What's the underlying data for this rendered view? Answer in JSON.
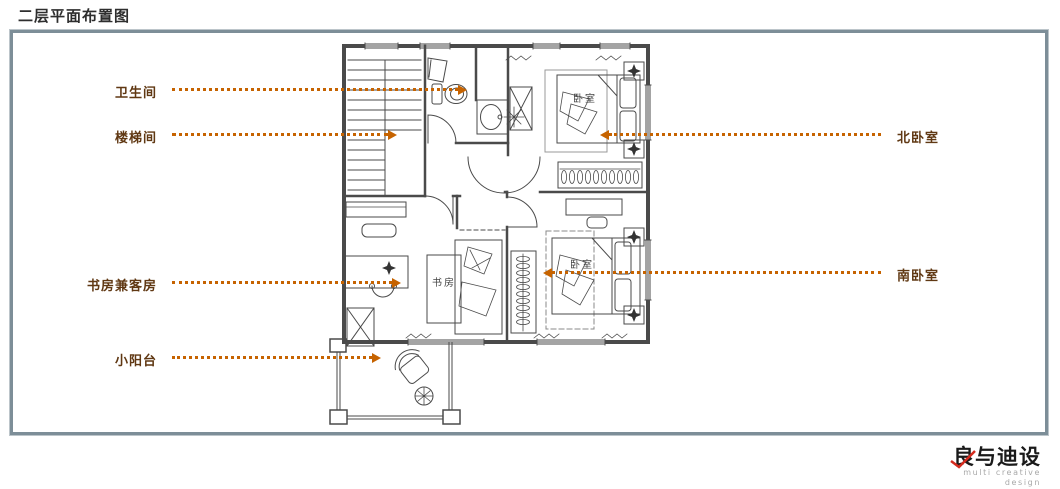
{
  "title": "二层平面布置图",
  "callouts": {
    "bathroom": "卫生间",
    "stairwell": "楼梯间",
    "study_guest": "书房兼客房",
    "balcony": "小阳台",
    "north_bedroom": "北卧室",
    "south_bedroom": "南卧室"
  },
  "plan": {
    "north_bedroom_label": "卧室",
    "south_bedroom_label": "卧室",
    "study_label": "书房"
  },
  "logo": {
    "cn": "良与迪设",
    "en": "multi creative design"
  },
  "colors": {
    "callout_text": "#603813",
    "leader_line": "#c66300",
    "panel_border": "#7d8e98",
    "walls": "#4a4a4a",
    "logo_accent": "#d42b1e"
  }
}
